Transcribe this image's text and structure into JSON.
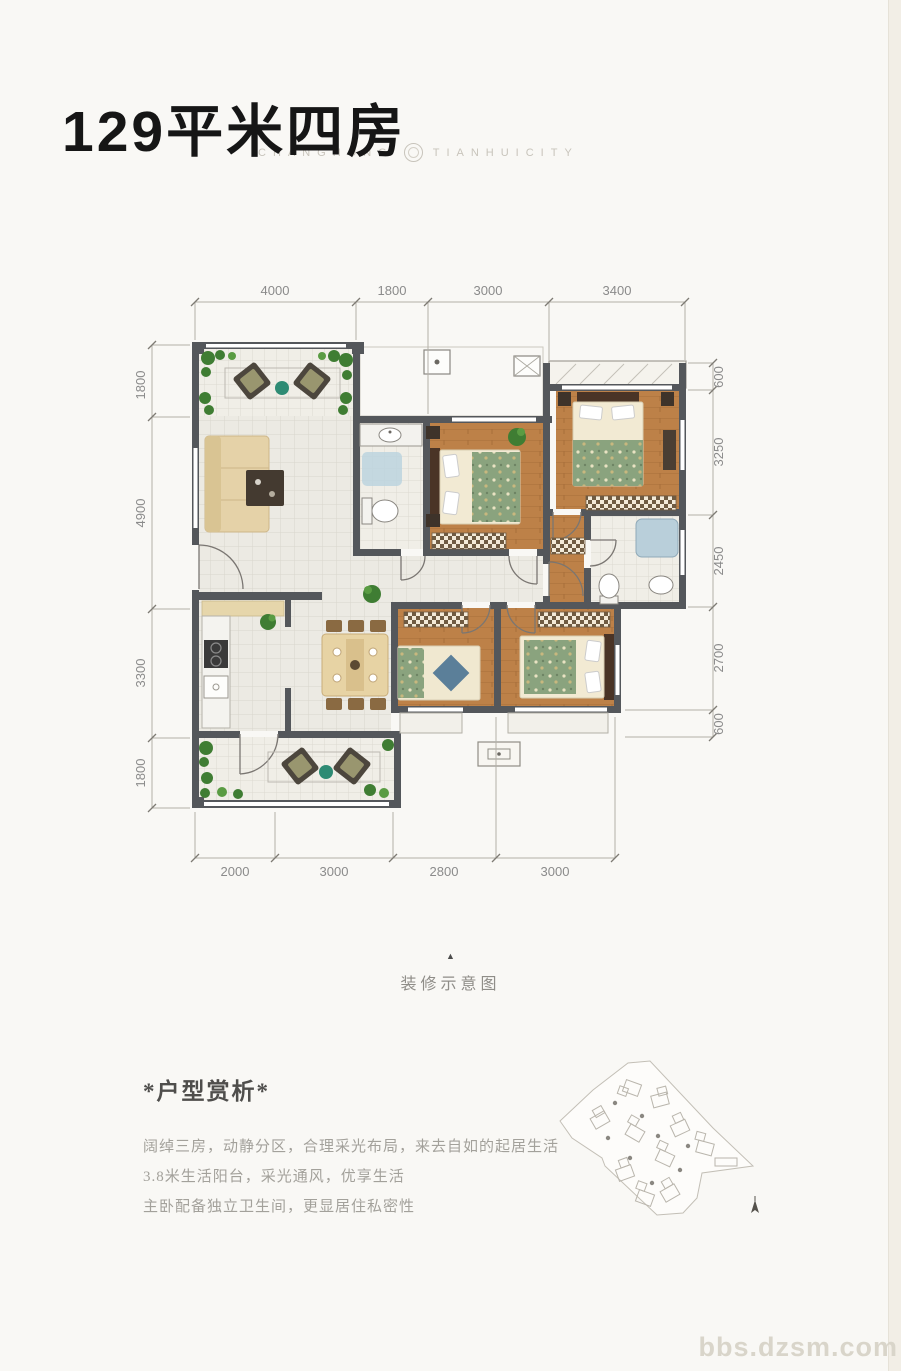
{
  "header": {
    "title": "129平米四房",
    "brand_left": "CHANGHONG",
    "brand_right": "TIANHUICITY"
  },
  "plan": {
    "dims_top": [
      "4000",
      "1800",
      "3000",
      "3400"
    ],
    "dims_bottom": [
      "2000",
      "3000",
      "2800",
      "3000"
    ],
    "dims_left": [
      "1800",
      "4900",
      "3300",
      "1800"
    ],
    "dims_right": [
      "600",
      "3250",
      "2450",
      "2700",
      "600"
    ],
    "caption_marker": "▲",
    "caption": "装修示意图"
  },
  "analysis": {
    "heading": "*户型赏析*",
    "line1": "阔绰三房，动静分区，合理采光布局，来去自如的起居生活",
    "line2": "3.8米生活阳台，采光通风，优享生活",
    "line3": "主卧配备独立卫生间，更显居住私密性"
  },
  "watermark": "bbs.dzsm.com",
  "colors": {
    "wall": "#54575b",
    "wood_floor": "#bd8148",
    "tile_floor": "#eceae3",
    "plant_green": "#3f7d33",
    "quilt_green": "#8aa37e",
    "water_blue": "#b9cfda"
  }
}
